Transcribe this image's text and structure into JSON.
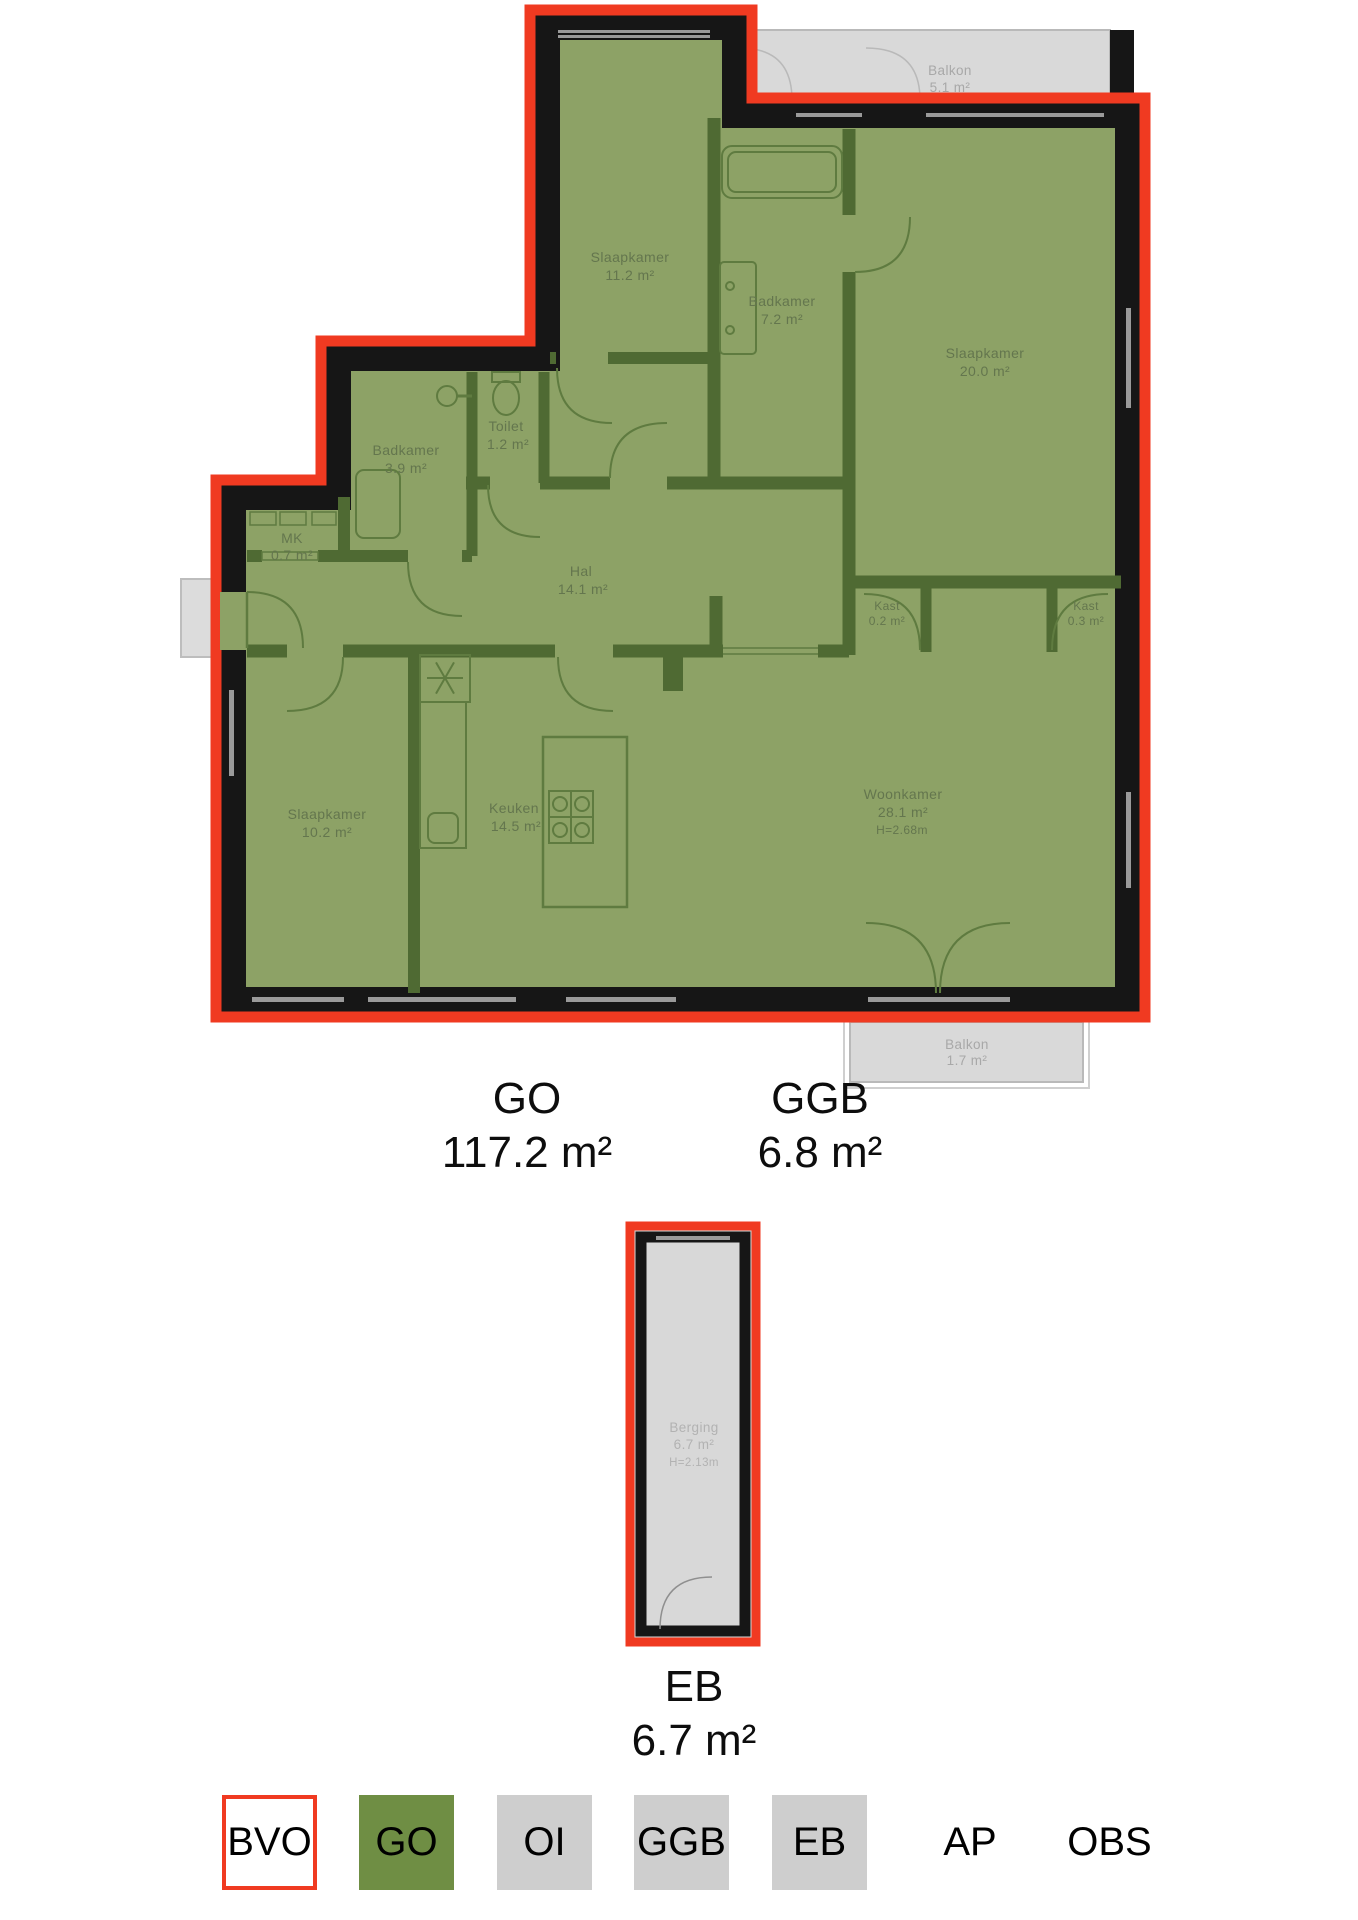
{
  "plan": {
    "balkon_top": {
      "name": "Balkon",
      "area": "5.1 m²"
    },
    "slaapkamer_1": {
      "name": "Slaapkamer",
      "area": "11.2 m²"
    },
    "badkamer_1": {
      "name": "Badkamer",
      "area": "7.2 m²"
    },
    "slaapkamer_2": {
      "name": "Slaapkamer",
      "area": "20.0 m²"
    },
    "toilet": {
      "name": "Toilet",
      "area": "1.2 m²"
    },
    "badkamer_2": {
      "name": "Badkamer",
      "area": "3.9 m²"
    },
    "mk": {
      "name": "MK",
      "area": "0.7 m²"
    },
    "hal": {
      "name": "Hal",
      "area": "14.1 m²"
    },
    "kast_1": {
      "name": "Kast",
      "area": "0.2 m²"
    },
    "kast_2": {
      "name": "Kast",
      "area": "0.3 m²"
    },
    "slaapkamer_3": {
      "name": "Slaapkamer",
      "area": "10.2 m²"
    },
    "keuken": {
      "name": "Keuken",
      "area": "14.5 m²"
    },
    "woonkamer": {
      "name": "Woonkamer",
      "area": "28.1 m²",
      "height": "H=2.68m"
    },
    "balkon_bottom": {
      "name": "Balkon",
      "area": "1.7 m²"
    },
    "berging": {
      "name": "Berging",
      "area": "6.7 m²",
      "height": "H=2.13m"
    }
  },
  "summary": {
    "go": {
      "label": "GO",
      "area": "117.2 m²"
    },
    "ggb": {
      "label": "GGB",
      "area": "6.8 m²"
    },
    "eb": {
      "label": "EB",
      "area": "6.7 m²"
    }
  },
  "legend": {
    "items": [
      {
        "label": "BVO"
      },
      {
        "label": "GO"
      },
      {
        "label": "OI"
      },
      {
        "label": "GGB"
      },
      {
        "label": "EB"
      },
      {
        "label": "AP"
      },
      {
        "label": "OBS"
      }
    ]
  },
  "colors": {
    "bvo_outline": "#f03a21",
    "go_fill": "#6f8e44",
    "room_fill": "#8da266",
    "gray_fill": "#cecece",
    "balcony_fill": "#d9d9d9"
  }
}
